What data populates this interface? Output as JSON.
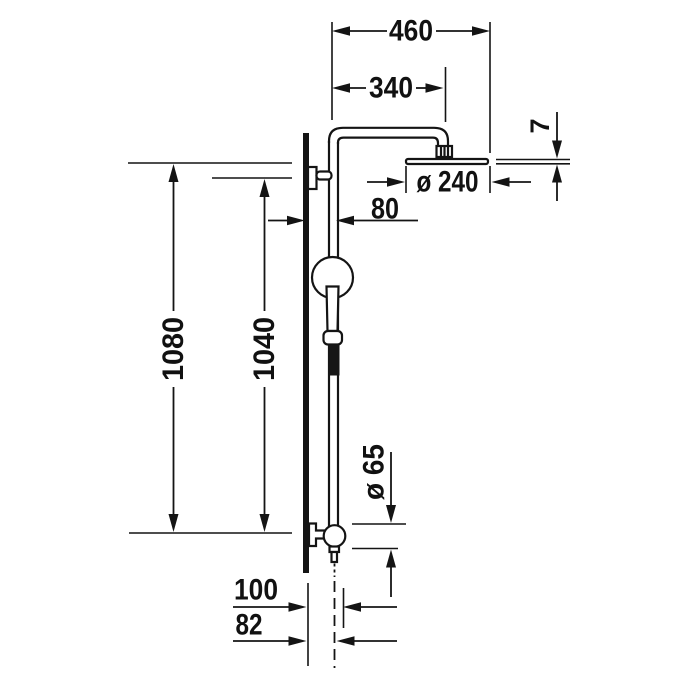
{
  "drawing": {
    "title": "Shower system dimensional drawing",
    "background": "#ffffff",
    "line_color": "#141414",
    "labels": {
      "arm_width": "460",
      "arm_projection": "340",
      "head_thickness": "7",
      "head_diameter": "ø 240",
      "wall_offset": "80",
      "height_total": "1080",
      "height_bar": "1040",
      "valve_diameter": "ø 65",
      "depth_total": "100",
      "depth_inner": "82"
    }
  }
}
